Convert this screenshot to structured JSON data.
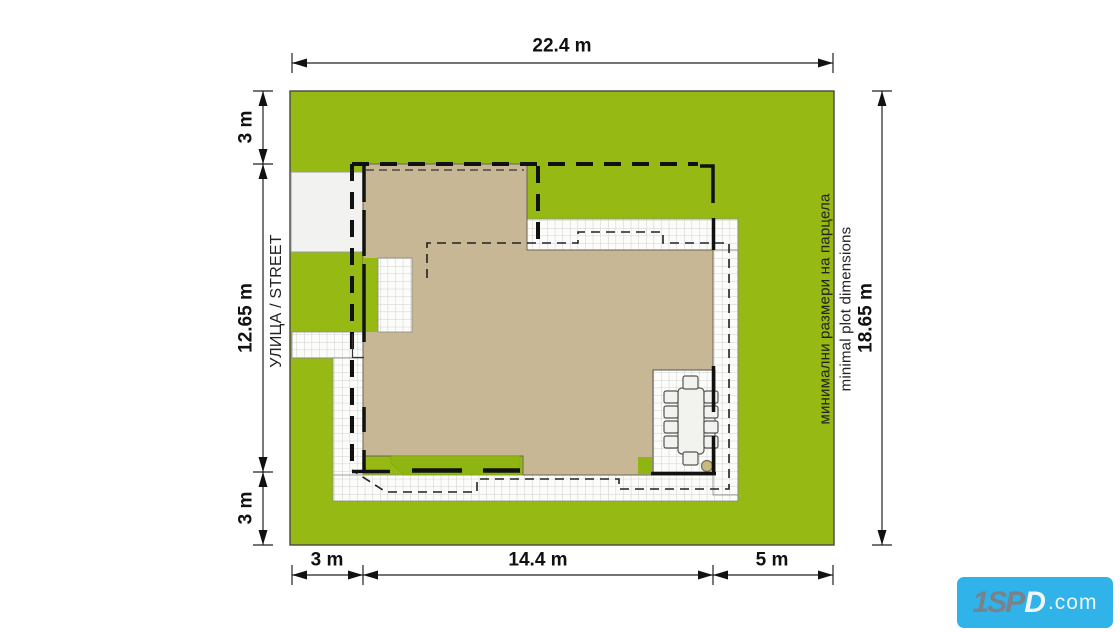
{
  "diagram": {
    "dim_top": "22.4 m",
    "dim_left_top": "3 m",
    "dim_left_mid": "12.65 m",
    "dim_left_bottom": "3 m",
    "dim_bottom_left": "3 m",
    "dim_bottom_mid": "14.4 m",
    "dim_bottom_right": "5 m",
    "dim_right": "18.65 m",
    "street_label": "УЛИЦА / STREET",
    "annotation_bg": "минимални размери на парцела",
    "annotation_en": "minimal plot dimensions"
  },
  "watermark": {
    "part1": "1SP",
    "part2": "D",
    "tld": ".com",
    "bg_color": "#2FB3E8"
  },
  "colors": {
    "plot_green": "#96BA13",
    "house_beige": "#C7B795",
    "paving_white": "#FCFCFB",
    "driveway_gray": "#F2F2F0",
    "canopy_green": "#8FB512",
    "line_black": "#111111"
  }
}
